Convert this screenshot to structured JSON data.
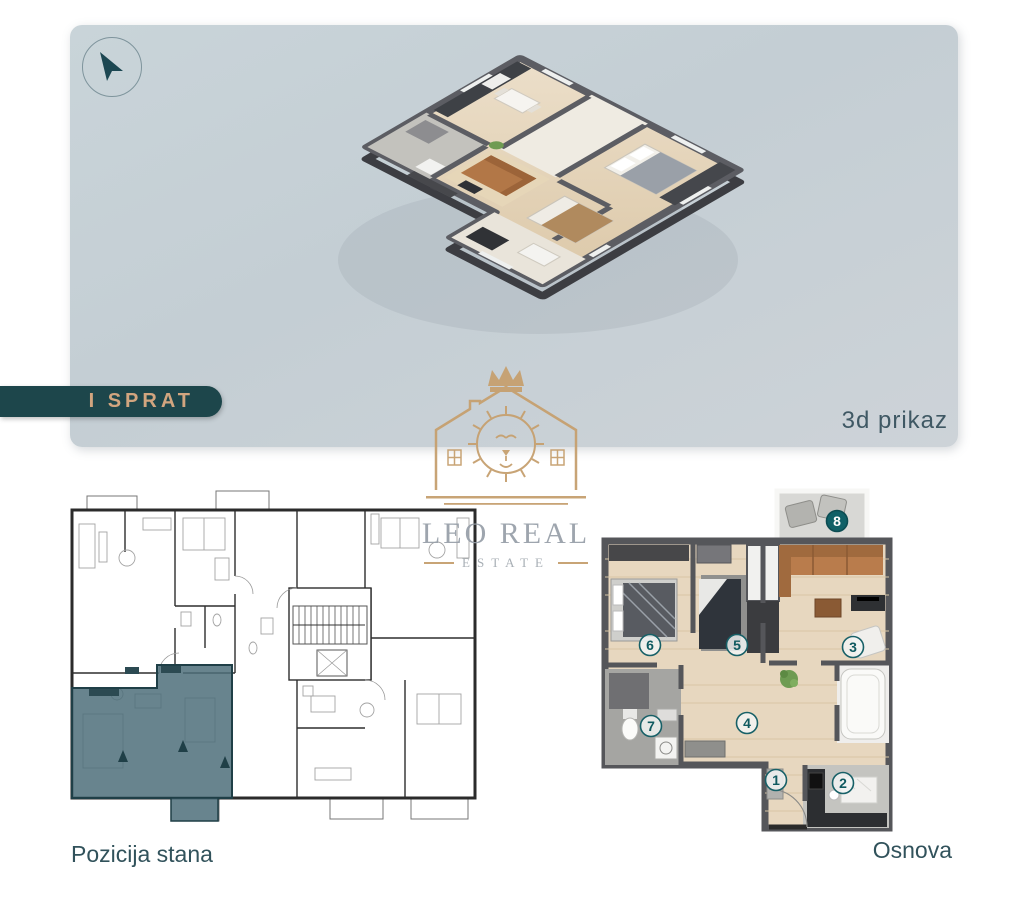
{
  "floor_banner": {
    "label": "I SPRAT"
  },
  "panel_3d": {
    "caption": "3d prikaz",
    "icon": "cursor-arrow-icon",
    "background": "#c7d1d6"
  },
  "watermark": {
    "title": "LEO REAL",
    "subtitle": "ESTATE",
    "icon": "lion-crown-house-logo",
    "gold_color": "#c6a06f",
    "text_color": "#99a1aa"
  },
  "plans": {
    "position": {
      "caption": "Pozicija stana",
      "highlight_color": "#4e6f7a"
    },
    "osnova": {
      "caption": "Osnova",
      "rooms": [
        "1",
        "2",
        "3",
        "4",
        "5",
        "6",
        "7",
        "8"
      ],
      "badge_color": "#106067",
      "wall_color": "#55565a",
      "floor_color": "#e7d7bf"
    }
  },
  "colors": {
    "banner_bg": "#1d464b",
    "banner_text": "#d2a57f",
    "caption_text": "#31525b"
  }
}
